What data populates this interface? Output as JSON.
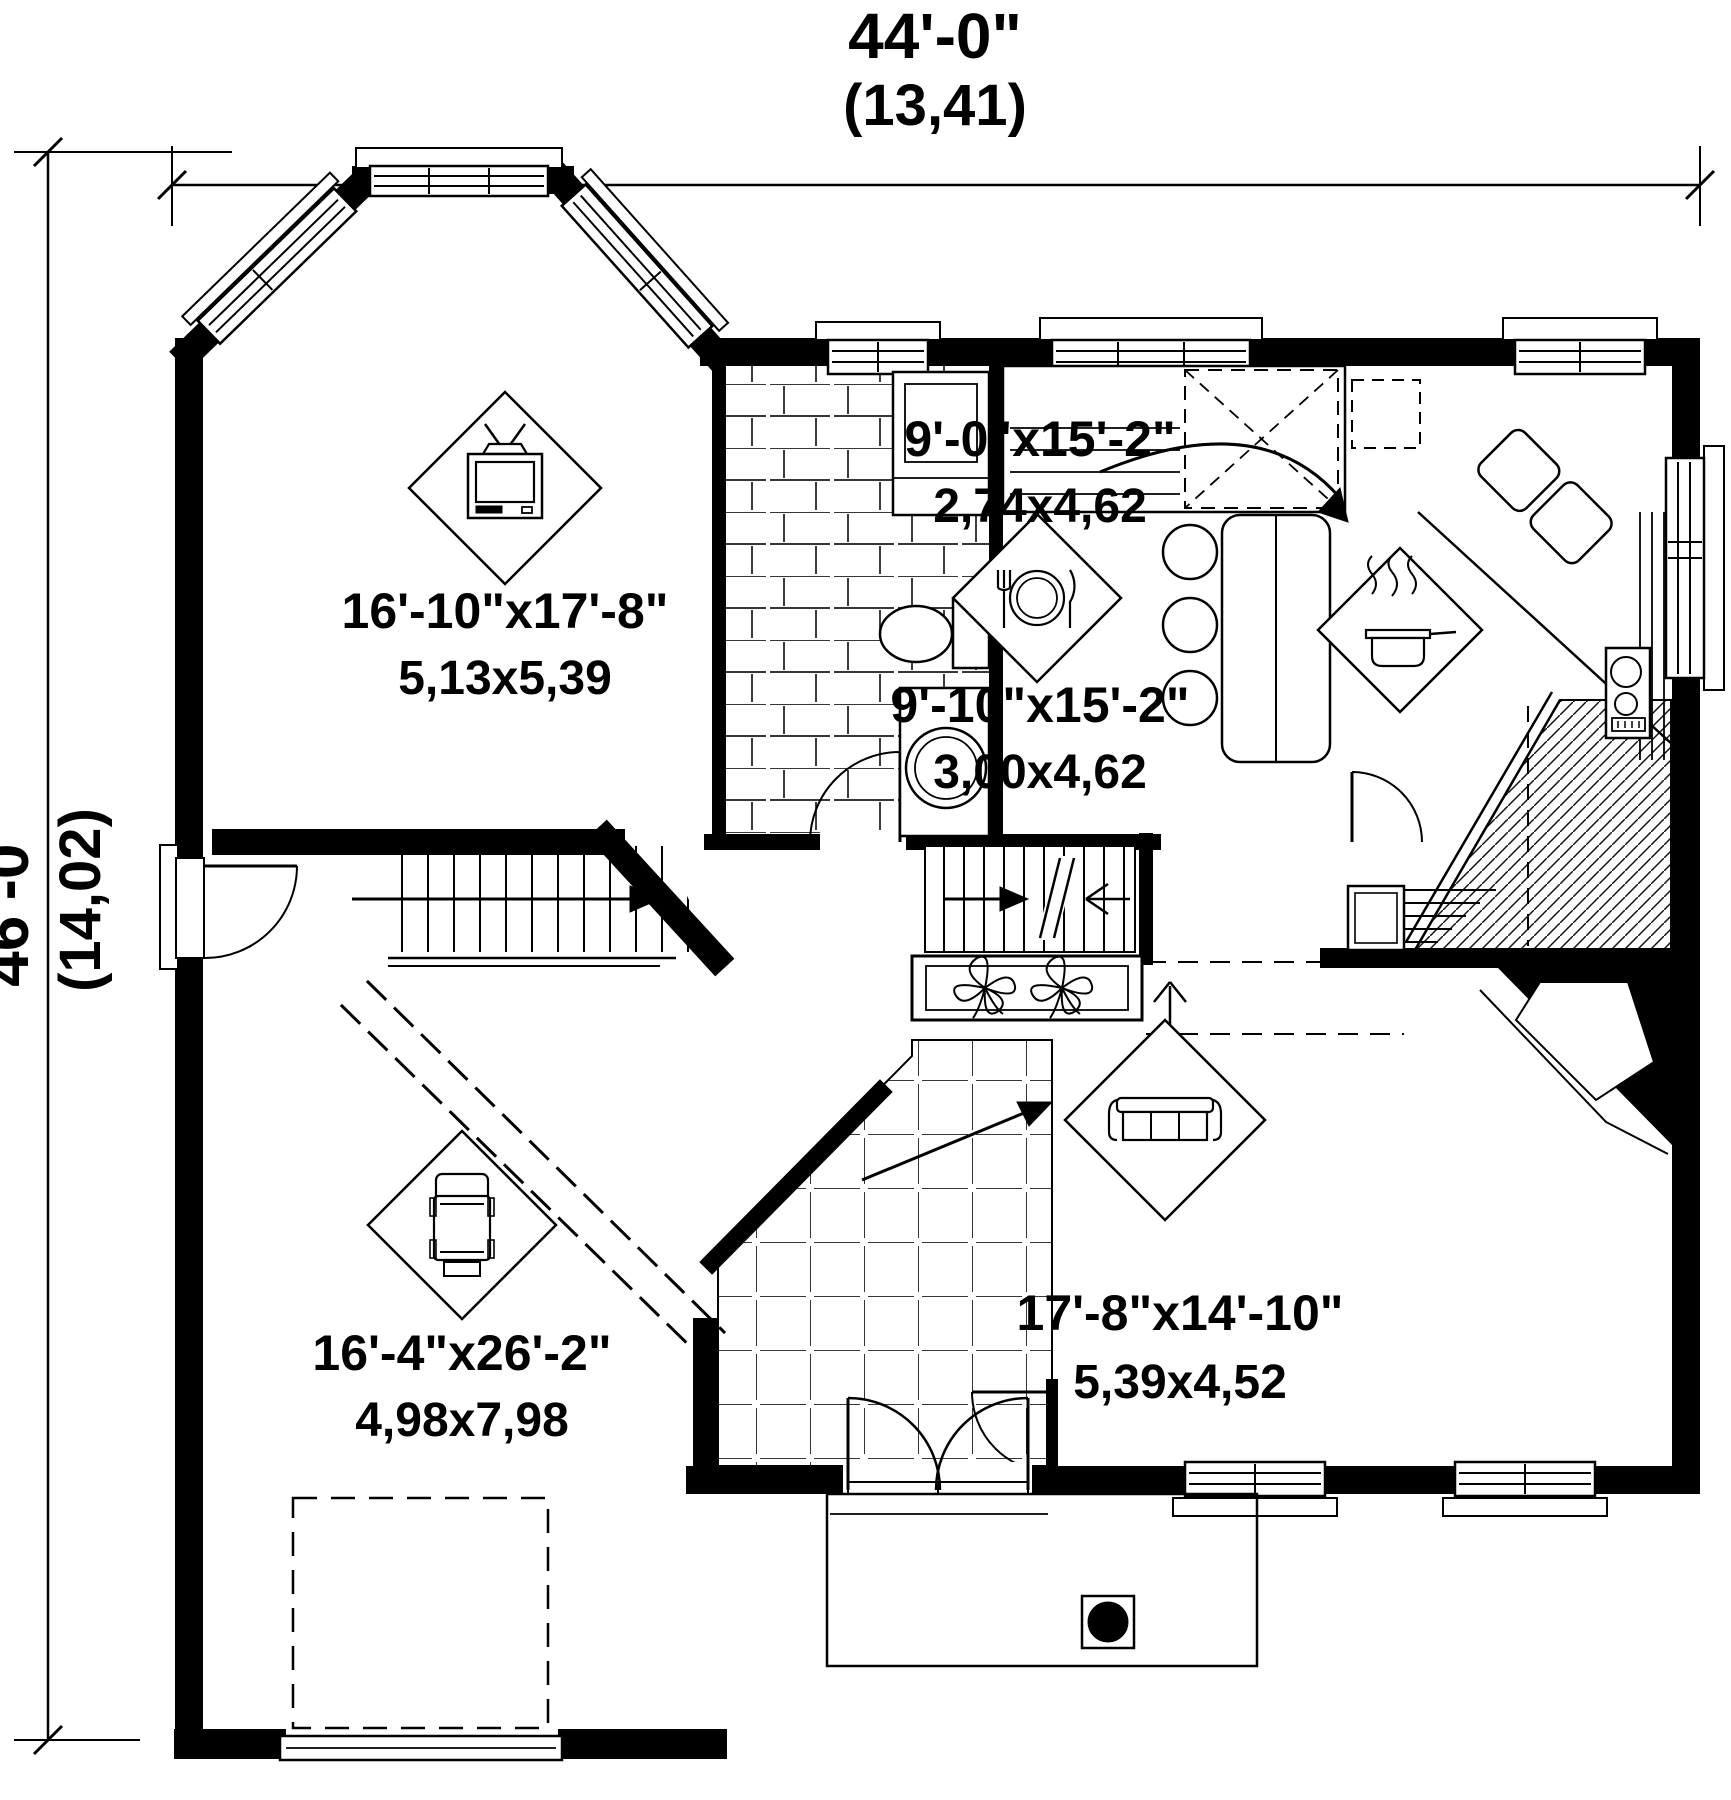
{
  "plan": {
    "dimensions": {
      "width_ft": "44'-0\"",
      "width_m": "(13,41)",
      "height_ft": "46'-0\"",
      "height_m": "(14,02)"
    },
    "rooms": {
      "family": {
        "imperial": "16'-10\"x17'-8\"",
        "metric": "5,13x5,39"
      },
      "kitchen": {
        "imperial": "9'-0\"x15'-2\"",
        "metric": "2,74x4,62"
      },
      "dining": {
        "imperial": "9'-10\"x15'-2\"",
        "metric": "3,00x4,62"
      },
      "living": {
        "imperial": "17'-8\"x14'-10\"",
        "metric": "5,39x4,52"
      },
      "garage": {
        "imperial": "16'-4\"x26'-2\"",
        "metric": "4,98x7,98"
      }
    },
    "colors": {
      "ink": "#000000",
      "paper": "#ffffff"
    }
  }
}
